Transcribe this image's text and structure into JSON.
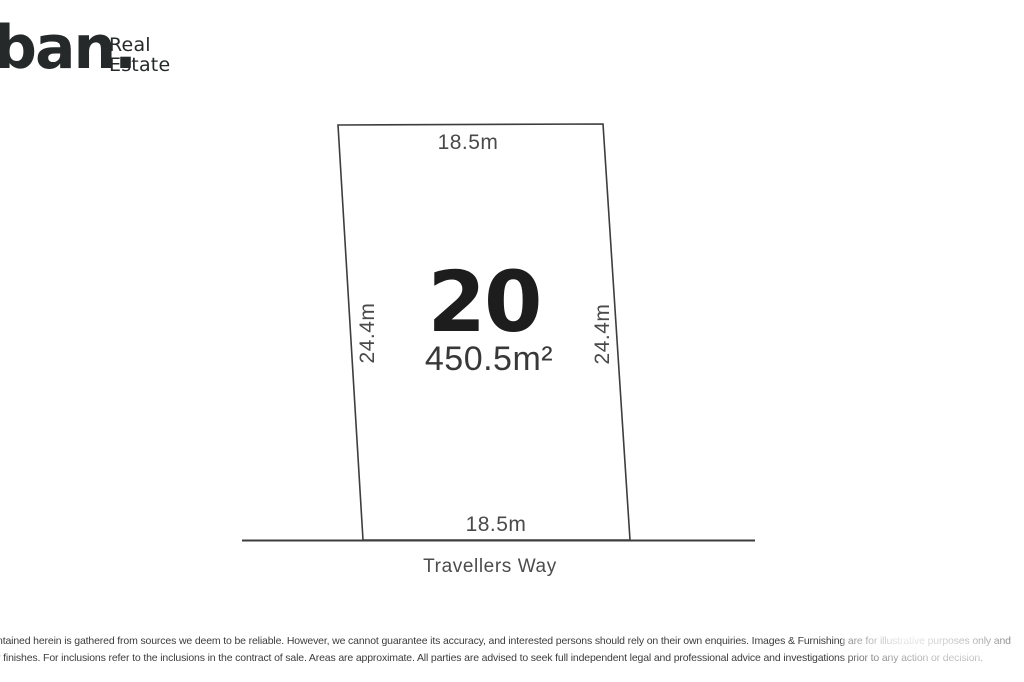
{
  "brand": {
    "wordmark": "ban.",
    "tagline_line1": "Real",
    "tagline_line2": "Estate"
  },
  "plan": {
    "lot_number": "20",
    "area": "450.5m²",
    "top_dimension": "18.5m",
    "bottom_dimension": "18.5m",
    "left_dimension": "24.4m",
    "right_dimension": "24.4m",
    "street_name": "Travellers Way"
  },
  "disclaimer": {
    "line1": "ntained herein is gathered from sources we deem to be reliable. However, we cannot guarantee its accuracy, and interested persons should rely on their own enquiries. Images & Furnishing are for illustrative purposes only and",
    "line2": "r finishes. For inclusions refer to the inclusions in the contract of sale. Areas are approximate. All parties are advised to seek full independent legal and professional advice and investigations prior to any action or decision."
  },
  "colors": {
    "ink": "#252929",
    "line": "#3d3d3d",
    "dim": "#4a4a4a",
    "lot": "#1d1d1d",
    "bg": "#ffffff"
  }
}
